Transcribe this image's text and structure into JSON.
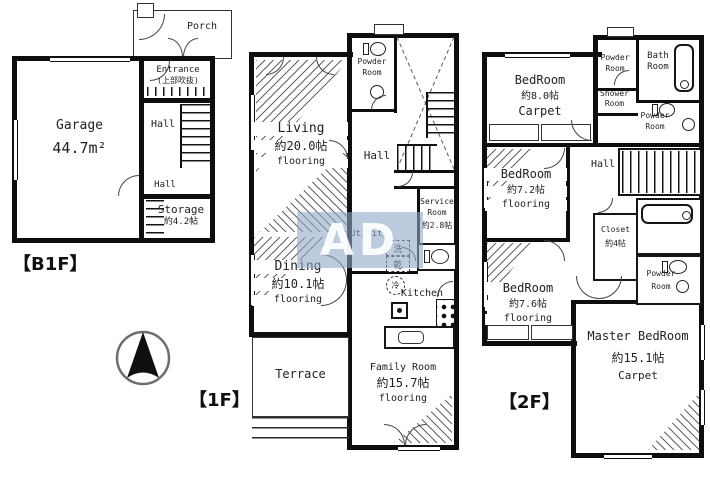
{
  "watermark": {
    "text": "AD"
  },
  "b1f": {
    "floor_label": "【B1F】",
    "porch": "Porch",
    "garage_name": "Garage",
    "garage_area": "44.7m²",
    "entrance_name": "Entrance",
    "entrance_note": "(上部吹抜)",
    "hall_upper": "Hall",
    "hall_lower": "Hall",
    "storage_name": "Storage",
    "storage_area": "約4.2帖"
  },
  "f1": {
    "floor_label": "【1F】",
    "powder_line1": "Powder",
    "powder_line2": "Room",
    "living_name": "Living",
    "living_area": "約20.0帖",
    "living_floor": "flooring",
    "hall": "Hall",
    "service_line1": "Service",
    "service_line2": "Room",
    "service_area": "約2.8帖",
    "utility": "Utility",
    "washer": "洗",
    "dryer": "乾",
    "fridge": "冷",
    "kitchen": "Kitchen",
    "dining_name": "Dining",
    "dining_area": "約10.1帖",
    "dining_floor": "flooring",
    "terrace": "Terrace",
    "family_name": "Family Room",
    "family_area": "約15.7帖",
    "family_floor": "flooring"
  },
  "f2": {
    "floor_label": "【2F】",
    "bedroom1_name": "BedRoom",
    "bedroom1_area": "約8.0帖",
    "bedroom1_floor": "Carpet",
    "powder_top_line1": "Powder",
    "powder_top_line2": "Room",
    "bath_line1": "Bath",
    "bath_line2": "Room",
    "shower_line1": "Shower",
    "shower_line2": "Room",
    "powder_mid_line1": "Powder",
    "powder_mid_line2": "Room",
    "bedroom2_name": "BedRoom",
    "bedroom2_area": "約7.2帖",
    "bedroom2_floor": "flooring",
    "hall": "Hall",
    "closet_name": "Closet",
    "closet_area": "約4帖",
    "powder_bottom_line1": "Powder",
    "powder_bottom_line2": "Room",
    "bedroom3_name": "BedRoom",
    "bedroom3_area": "約7.6帖",
    "bedroom3_floor": "flooring",
    "master_name": "Master BedRoom",
    "master_area": "約15.1帖",
    "master_floor": "Carpet"
  }
}
